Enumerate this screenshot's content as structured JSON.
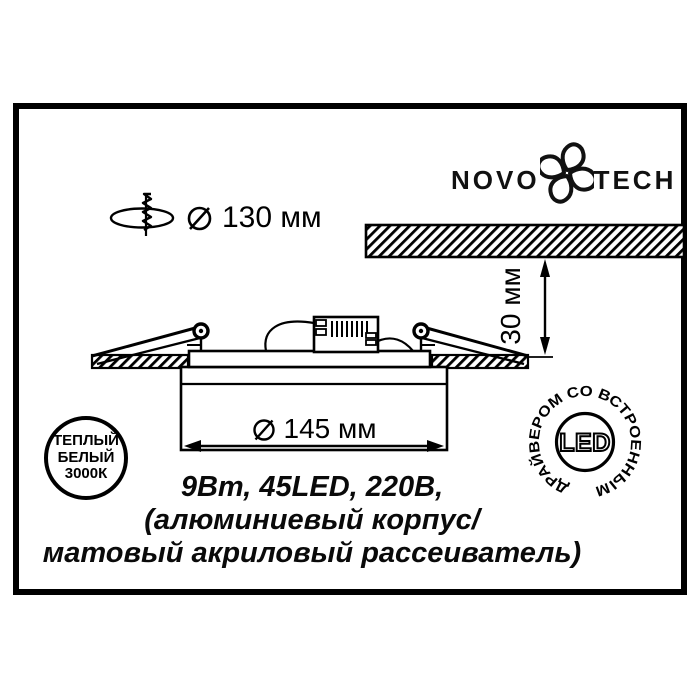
{
  "colors": {
    "ink": "#000000",
    "paper": "#ffffff"
  },
  "brand": {
    "name_left": "NOVO",
    "name_right": "TECH",
    "flower_icon": "novotech-flower-icon"
  },
  "dimensions": {
    "cutout_diameter": "130 мм",
    "recess_depth": "30 мм",
    "body_diameter": "145 мм"
  },
  "icons": {
    "drill": "drill-hole-icon",
    "diameter_symbol": "diameter-symbol-icon"
  },
  "specs": {
    "line1": "9Вт, 45LED, 220В,",
    "line2": "(алюминиевый корпус/",
    "line3": "матовый акриловый рассеиватель)"
  },
  "warm_badge": {
    "line1": "ТЕПЛЫЙ",
    "line2": "БЕЛЫЙ",
    "line3": "3000К"
  },
  "led_badge": {
    "center_text": "LED",
    "ring_text": "ДРАЙВЕРОМ СО ВСТРОЕННЫМ"
  }
}
